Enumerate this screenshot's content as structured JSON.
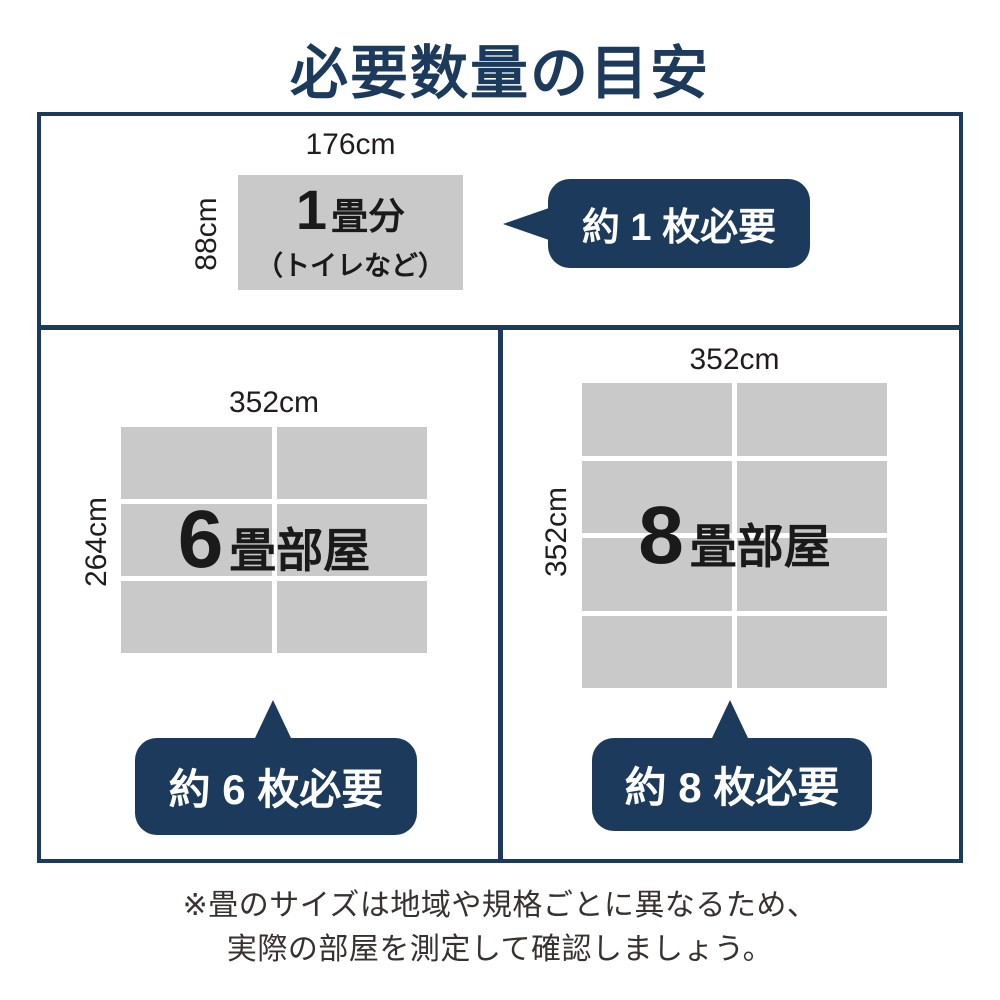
{
  "title": "必要数量の目安",
  "colors": {
    "navy": "#1c3a5c",
    "gray": "#c9c9c9",
    "text_dark": "#1a1a1a",
    "footer_text": "#37312f"
  },
  "panels": {
    "one_tatami": {
      "width_label": "176cm",
      "height_label": "88cm",
      "room_number": "1",
      "room_suffix": "畳分",
      "room_note": "（トイレなど）",
      "bubble_label": "約 1 枚必要"
    },
    "six_tatami": {
      "width_label": "352cm",
      "height_label": "264cm",
      "room_number": "6",
      "room_suffix": "畳部屋",
      "bubble_label": "約 6 枚必要",
      "grid": {
        "cols": 2,
        "rows": 3
      }
    },
    "eight_tatami": {
      "width_label": "352cm",
      "height_label": "352cm",
      "room_number": "8",
      "room_suffix": "畳部屋",
      "bubble_label": "約 8 枚必要",
      "grid": {
        "cols": 2,
        "rows": 4
      }
    }
  },
  "footer": {
    "line1": "※畳のサイズは地域や規格ごとに異なるため、",
    "line2": "実際の部屋を測定して確認しましょう。"
  }
}
